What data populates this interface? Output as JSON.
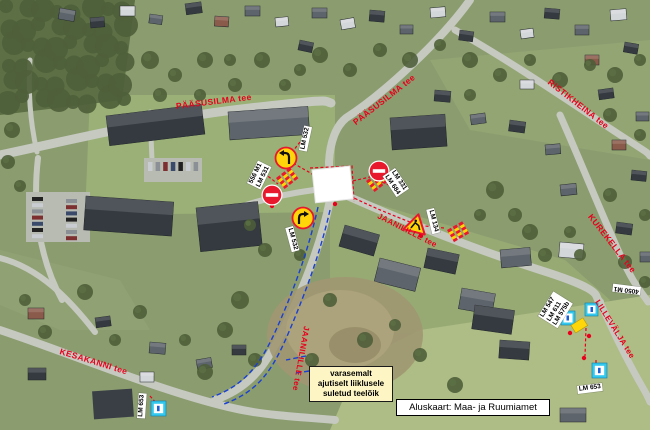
{
  "streets": {
    "paasusilma1": "PÄÄSUSILMA tee",
    "paasusilma2": "PÄÄSUSILMA tee",
    "ristikheina": "RISTIKHEINA tee",
    "kurekella": "KUREKELLA tee",
    "jaanilille1": "JAANILILLE tee",
    "jaanilille2": "JAANILILLE tee",
    "kesakanni": "KESAKANNI tee",
    "lillevalja": "LILLEVÄLJA tee"
  },
  "sign_labels": {
    "lm532_top": "LM 532",
    "left_pair_line1": "556 M1",
    "left_pair_line2": "LM 531",
    "right_pair_line1": "LM 331",
    "right_pair_line2": "LM 684",
    "lm532_bottom": "LM 532",
    "lm134": "LM 134",
    "cluster_line1": "LM 547",
    "cluster_line2": "LM 611",
    "cluster_line3": "LM 575b",
    "cluster_top": "4050 M1",
    "lm653_right": "LM 653",
    "lm653_left": "LM 653"
  },
  "note": {
    "line1": "varasemalt",
    "line2": "ajutiselt liiklusele",
    "line3": "suletud teelõik"
  },
  "credit": "Aluskaart: Maa- ja Ruumiamet",
  "colors": {
    "annotation_red": "#e8001d",
    "route_blue": "#1a3fd4",
    "note_bg": "#fdf6c4",
    "sign_yellow": "#ffd60a",
    "sign_cyan": "#35c8ee",
    "no_entry_red": "#e8192c"
  }
}
